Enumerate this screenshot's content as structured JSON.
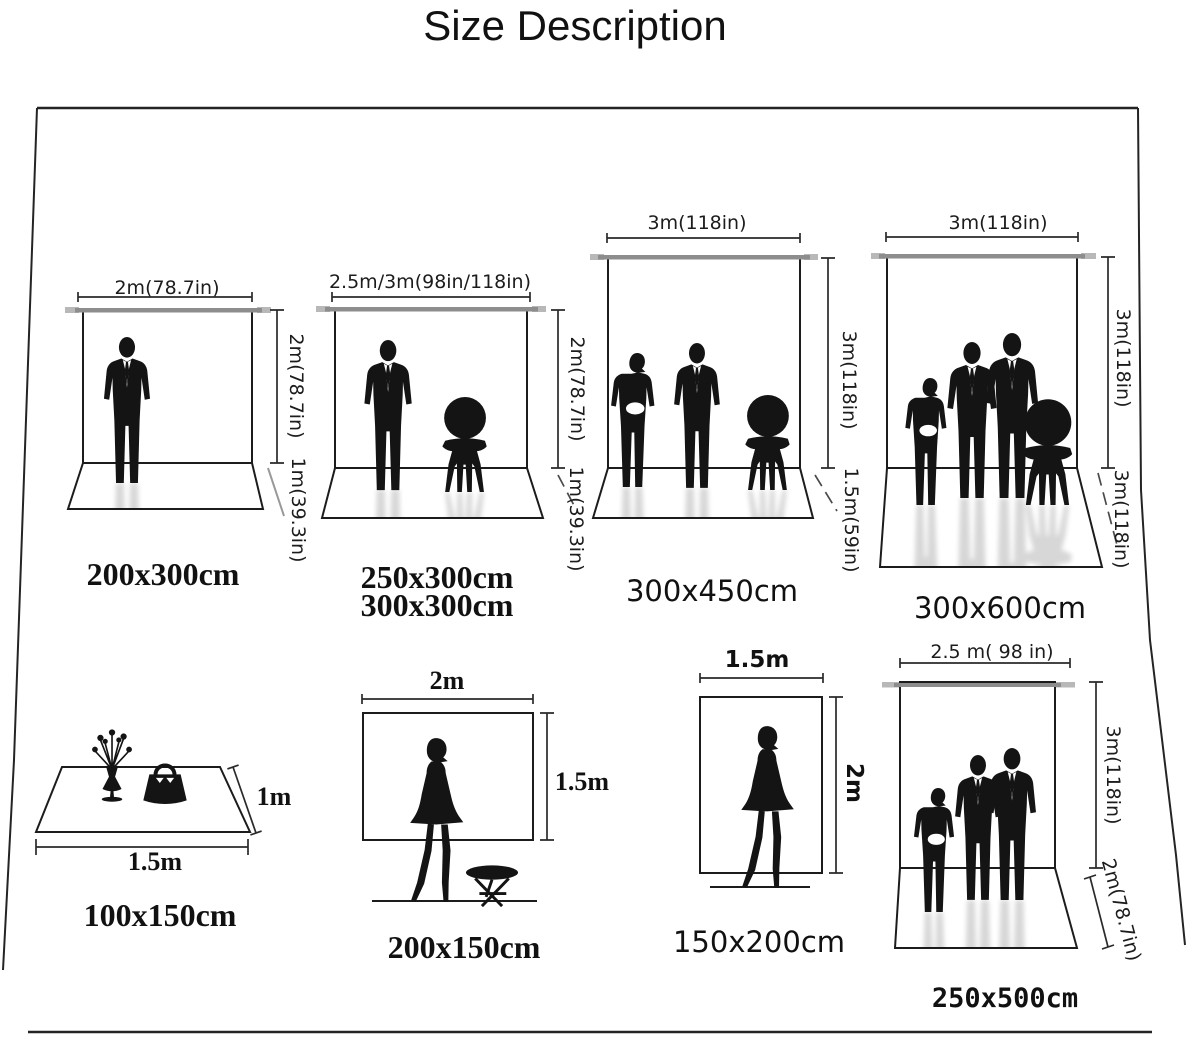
{
  "title": "Size Description",
  "colors": {
    "ink": "#1c1c1c",
    "silhouette": "#141414",
    "crossbar": "#8d8d8d",
    "crossbar_stub": "#b8b8b8",
    "background": "#ffffff"
  },
  "diagrams": [
    {
      "name": "backdrop-200x300",
      "caption": "200x300cm",
      "width_label": "2m(78.7in)",
      "height_label": "2m(78.7in)",
      "depth_label": "1m(39.3in)",
      "figures": [
        "man"
      ]
    },
    {
      "name": "backdrop-250x300-300x300",
      "caption": "250x300cm",
      "caption2": "300x300cm",
      "width_label": "2.5m/3m(98in/118in)",
      "height_label": "2m(78.7in)",
      "depth_label": "1m(39.3in)",
      "figures": [
        "man",
        "chair"
      ]
    },
    {
      "name": "backdrop-300x450",
      "caption": "300x450cm",
      "width_label": "3m(118in)",
      "height_label": "3m(118in)",
      "depth_label": "1.5m(59in)",
      "figures": [
        "woman",
        "man",
        "chair"
      ]
    },
    {
      "name": "backdrop-300x600",
      "caption": "300x600cm",
      "width_label": "3m(118in)",
      "height_label": "3m(118in)",
      "depth_label": "3m(118in)",
      "figures": [
        "woman",
        "man",
        "man",
        "chair"
      ]
    },
    {
      "name": "mat-100x150",
      "caption": "100x150cm",
      "width_label": "1.5m",
      "height_label": "1m",
      "figures": [
        "flower-vase",
        "handbag"
      ]
    },
    {
      "name": "backdrop-200x150",
      "caption": "200x150cm",
      "width_label": "2m",
      "height_label": "1.5m",
      "figures": [
        "woman",
        "stool"
      ]
    },
    {
      "name": "backdrop-150x200",
      "caption": "150x200cm",
      "width_label": "1.5m",
      "height_label": "2m",
      "figures": [
        "woman"
      ]
    },
    {
      "name": "backdrop-250x500",
      "caption": "250x500cm",
      "width_label": "2.5 m( 98 in)",
      "height_label": "3m(118in)",
      "depth_label": "2m(78.7in)",
      "figures": [
        "woman",
        "man",
        "man"
      ]
    }
  ]
}
